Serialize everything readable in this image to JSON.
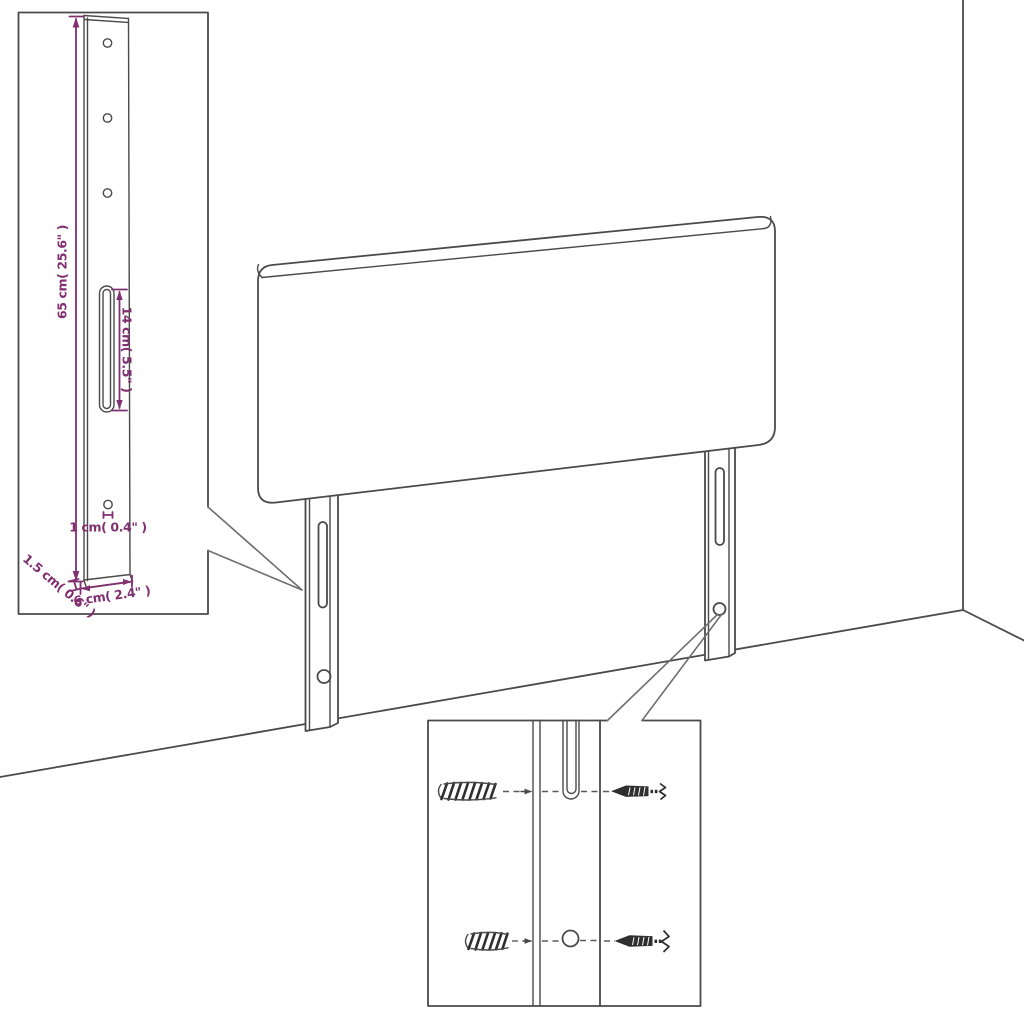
{
  "figure": {
    "type": "furniture-assembly-diagram",
    "subject": "headboard with two mounting legs shown against a room corner",
    "insets": [
      "leg-dimension-detail",
      "wall-mounting-hardware-detail"
    ]
  },
  "colors": {
    "line": "#4a4a4a",
    "dimension": "#802f70",
    "background": "#ffffff"
  },
  "dimensions": {
    "height_label": "65 cm( 25.6\" )",
    "slot_label": "14 cm( 5.5\" )",
    "hole_label": "1 cm( 0.4\" )",
    "thickness_label": "1.5 cm( 0.6\" )",
    "width_label": "6 cm( 2.4\" )"
  },
  "hardware": {
    "anchor_icon": "wall-plug-icon",
    "screw_icon": "screw-icon"
  }
}
